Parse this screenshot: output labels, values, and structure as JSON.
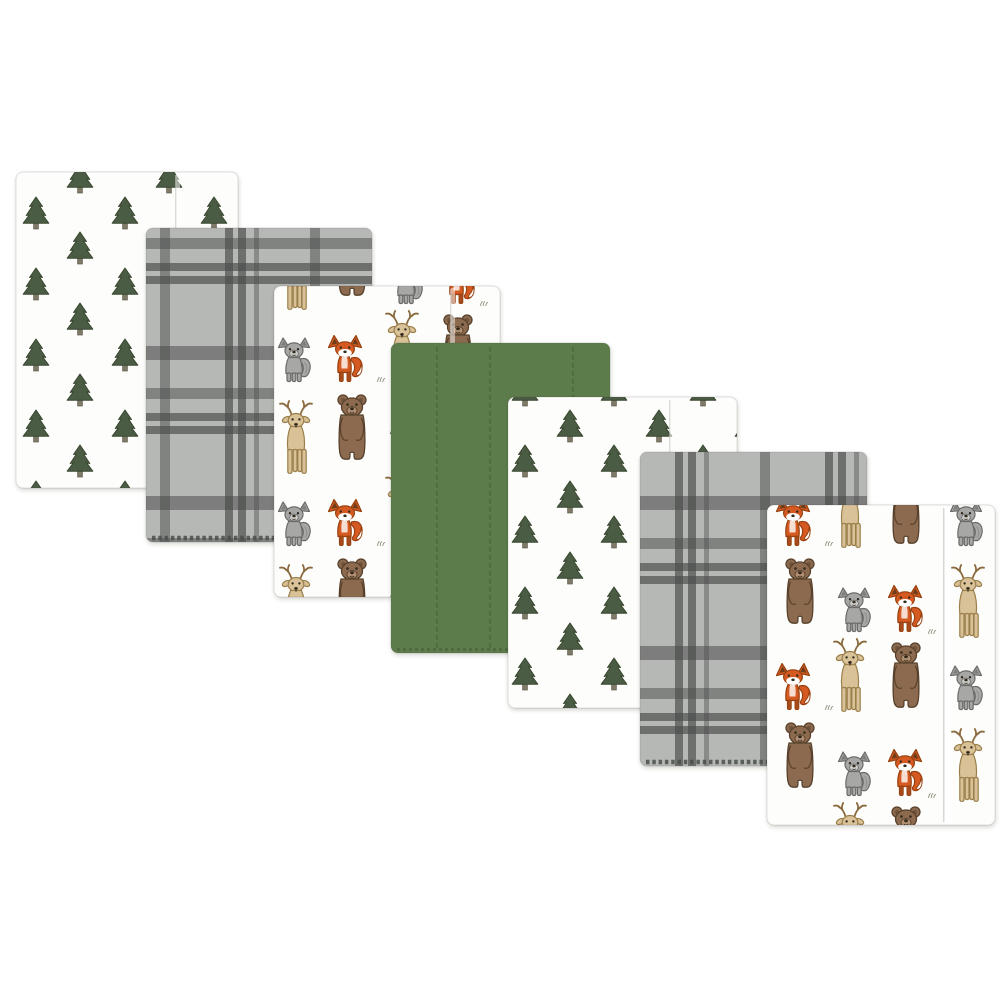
{
  "scene": {
    "alt": "Product photo: seven flannel baby burp cloths in a woodland theme, fanned diagonally from upper left to lower right on a white background",
    "background": "#ffffff",
    "width": 1000,
    "height": 1000
  },
  "palette": {
    "page_bg": "#ffffff",
    "cloth_white": "#fdfdfb",
    "edge_line": "rgba(70,70,64,0.16)",
    "tree_green": "#4c5b44",
    "tree_outline": "#39462f",
    "tree_trunk": "#7f7968",
    "trunk_outline": "#5e5949",
    "plaid_base": "#b6b8b5",
    "plaid_dark": "#4a4d4b",
    "solid_green": "#5d7c4c",
    "solid_green_dark": "#48623a",
    "bear_brown": "#8b6a4f",
    "bear_outline": "#59412c",
    "bear_muzzle": "#af8f70",
    "deer_tan": "#d9c297",
    "deer_outline": "#9b7f4c",
    "antler": "#8a6a3e",
    "wolf_gray": "#a7a7a5",
    "wolf_outline": "#6b6b69",
    "wolf_light": "#cdcdca",
    "wolf_inner": "#7d7d7b",
    "fox_orange": "#d45a23",
    "fox_outline": "#98400f",
    "fox_leg": "#a84c1a",
    "fox_inner": "#6e3d1c",
    "ink": "#33291f",
    "grass": "#8b8b78",
    "fold_white": "#ffffff",
    "fold_line": "#c9c9c4"
  },
  "patterns": {
    "pine-trees": {
      "label": "Pine trees on white"
    },
    "gray-plaid": {
      "label": "Gray and charcoal plaid"
    },
    "woodland-animals": {
      "label": "Woodland animals (deer, bear, wolf, fox) on white"
    },
    "solid-green": {
      "label": "Solid forest green"
    }
  },
  "cloths": [
    {
      "name": "burp-cloth-1-pine-trees",
      "pattern": "pine-trees",
      "x": 16,
      "y": 172,
      "w": 222,
      "h": 316,
      "seams": [
        {
          "x": 178,
          "style": "fold"
        }
      ]
    },
    {
      "name": "burp-cloth-2-gray-plaid",
      "pattern": "gray-plaid",
      "x": 146,
      "y": 228,
      "w": 226,
      "h": 314,
      "hem_stitch": "plaid"
    },
    {
      "name": "burp-cloth-3-woodland-animals",
      "pattern": "woodland-animals",
      "x": 274,
      "y": 286,
      "w": 226,
      "h": 311,
      "seams": [
        {
          "x": 453,
          "style": "fold"
        }
      ]
    },
    {
      "name": "burp-cloth-4-solid-green",
      "pattern": "solid-green",
      "x": 391,
      "y": 343,
      "w": 219,
      "h": 310,
      "seams": [
        {
          "x": 437,
          "style": "stitch"
        },
        {
          "x": 490,
          "style": "stitch"
        },
        {
          "x": 573,
          "style": "stitch"
        }
      ],
      "hem_stitch": "green"
    },
    {
      "name": "burp-cloth-5-pine-trees",
      "pattern": "pine-trees",
      "x": 508,
      "y": 397,
      "w": 229,
      "h": 311,
      "seams": [
        {
          "x": 672,
          "style": "fold"
        }
      ]
    },
    {
      "name": "burp-cloth-6-gray-plaid",
      "pattern": "gray-plaid",
      "x": 640,
      "y": 452,
      "w": 227,
      "h": 314,
      "hem_stitch": "plaid"
    },
    {
      "name": "burp-cloth-7-woodland-animals",
      "pattern": "woodland-animals",
      "x": 767,
      "y": 505,
      "w": 228,
      "h": 320,
      "seams": [
        {
          "x": 947,
          "style": "fold-strong"
        }
      ]
    }
  ]
}
